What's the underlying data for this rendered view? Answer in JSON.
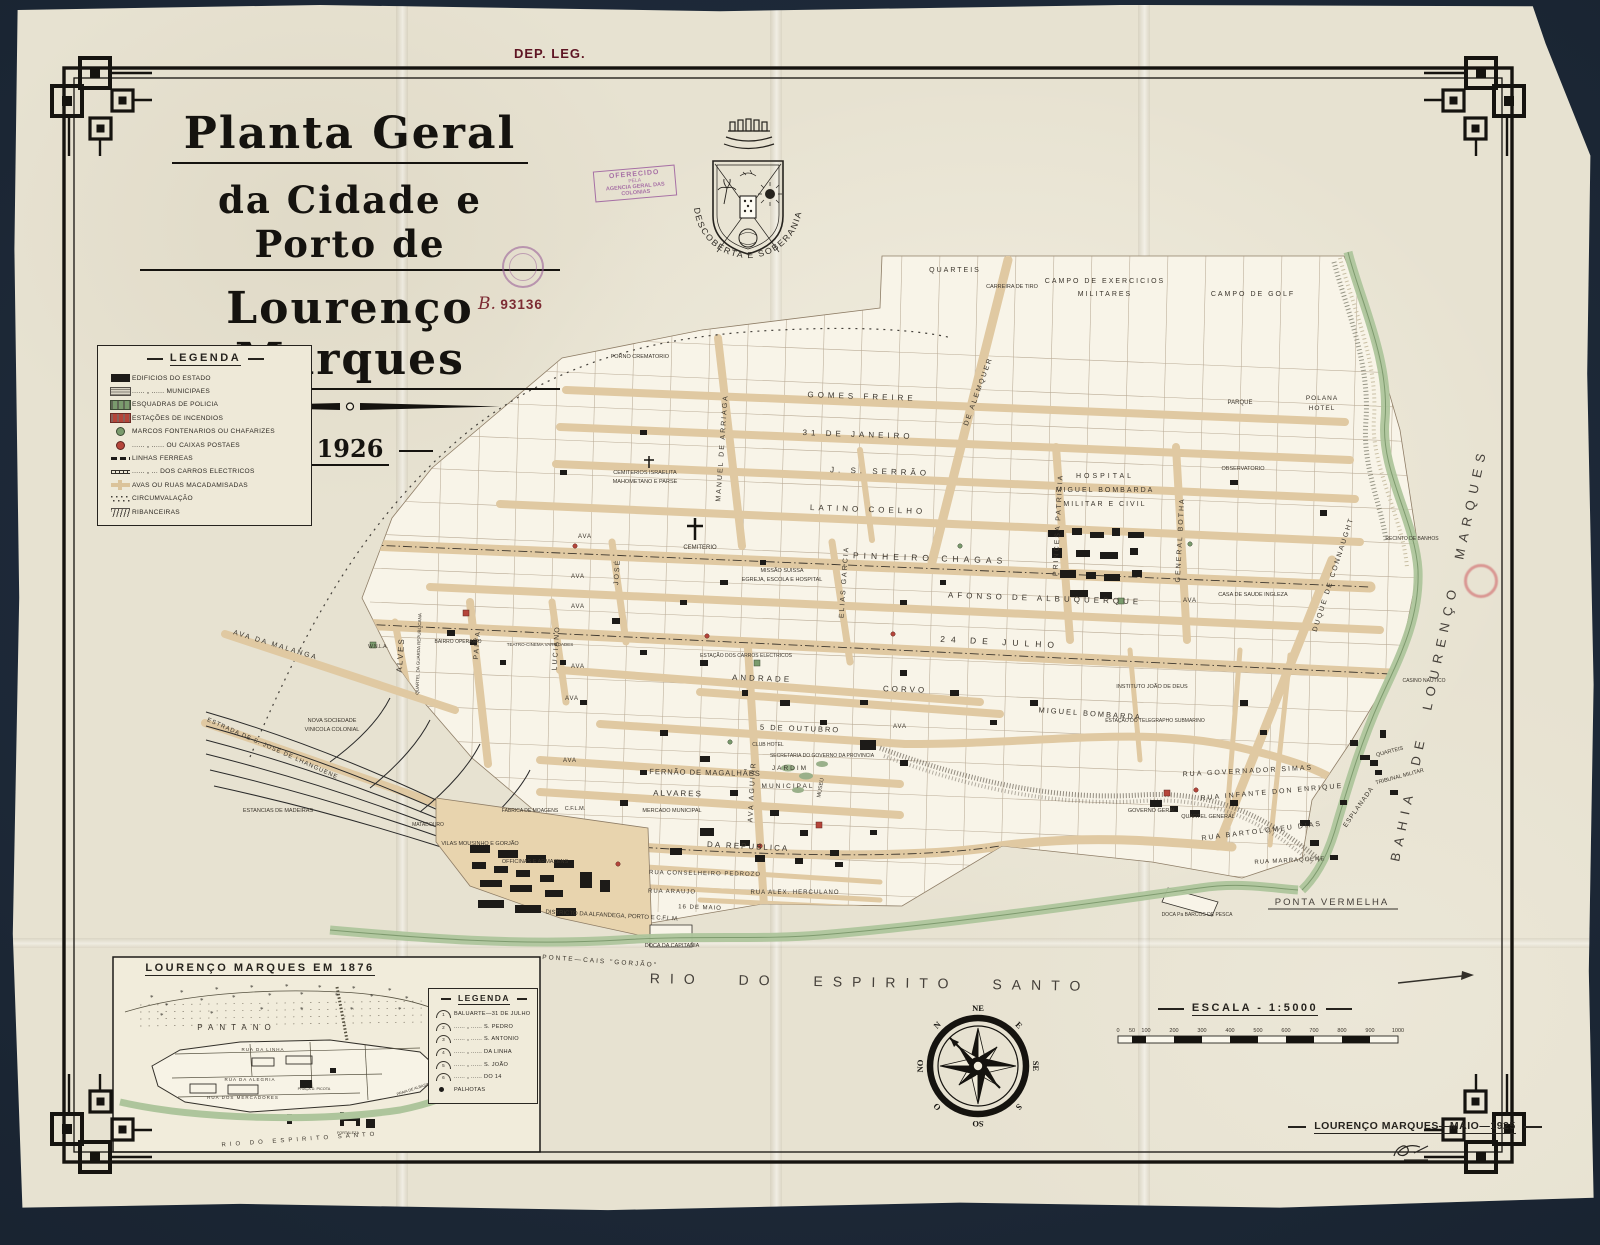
{
  "dep_leg": "DEP. LEG.",
  "title": {
    "line1": "Planta Geral",
    "line2": "da Cidade e Porto de",
    "line3": "Lourenço Marques",
    "year": "1926"
  },
  "stamps": {
    "offered": {
      "l1": "OFERECIDO",
      "l2": "PELA",
      "l3": "AGENCIA GERAL DAS COLONIAS"
    },
    "registry": {
      "prefix": "B.",
      "number": "93136"
    }
  },
  "crest": {
    "motto": "DESCOBERTA E SOBERANIA PORTUGUESA"
  },
  "legend": {
    "title": "LEGENDA",
    "items": [
      {
        "c": "sym sym-state",
        "label": "EDIFICIOS DO ESTADO"
      },
      {
        "c": "sym sym-municipal",
        "label": "...... „ ...... MUNICIPAES"
      },
      {
        "c": "sym sym-police",
        "label": "ESQUADRAS DE POLICIA"
      },
      {
        "c": "sym sym-fire",
        "label": "ESTAÇÕES DE INCENDIOS"
      },
      {
        "c": "sym sym-fountain",
        "label": "MARCOS FONTENARIOS OU CHAFARIZES"
      },
      {
        "c": "sym sym-postbox",
        "label": "...... „ ...... OU CAIXAS POSTAES"
      },
      {
        "c": "sym sym-rail",
        "label": "LINHAS FERREAS"
      },
      {
        "c": "sym sym-tram",
        "label": "...... „ ... DOS CARROS ELECTRICOS"
      },
      {
        "c": "sym sym-macadam",
        "label": "AVAS OU RUAS MACADAMISADAS"
      },
      {
        "c": "sym sym-circum",
        "label": "CIRCUMVALAÇÃO"
      },
      {
        "c": "sym sym-riban",
        "label": "RIBANCEIRAS"
      }
    ]
  },
  "map": {
    "labels": [
      {
        "t": "GOMES FREIRE",
        "x": 862,
        "y": 399,
        "r": 2,
        "s": 8,
        "ls": 4
      },
      {
        "t": "31 DE JANEIRO",
        "x": 858,
        "y": 437,
        "r": 2,
        "s": 8,
        "ls": 4
      },
      {
        "t": "J. S. SERRÃO",
        "x": 880,
        "y": 474,
        "r": 2,
        "s": 8,
        "ls": 4
      },
      {
        "t": "LATINO COELHO",
        "x": 868,
        "y": 512,
        "r": 2,
        "s": 8,
        "ls": 4
      },
      {
        "t": "PINHEIRO CHAGAS",
        "x": 930,
        "y": 561,
        "r": 2,
        "s": 8.5,
        "ls": 5
      },
      {
        "t": "AFONSO DE ALBUQUERQUE",
        "x": 1045,
        "y": 601,
        "r": 2,
        "s": 8,
        "ls": 4
      },
      {
        "t": "24 DE JULHO",
        "x": 1000,
        "y": 645,
        "r": 3,
        "s": 8.5,
        "ls": 6
      },
      {
        "t": "ANDRADE",
        "x": 762,
        "y": 681,
        "r": 2,
        "s": 8,
        "ls": 3
      },
      {
        "t": "CORVO",
        "x": 905,
        "y": 692,
        "r": 2,
        "s": 8,
        "ls": 3
      },
      {
        "t": "5 DE OUTUBRO",
        "x": 800,
        "y": 731,
        "r": 2,
        "s": 7.5,
        "ls": 2
      },
      {
        "t": "MIGUEL BOMBARDA",
        "x": 1090,
        "y": 716,
        "r": 4,
        "s": 7.5,
        "ls": 2
      },
      {
        "t": "FERNÃO DE MAGALHÃES",
        "x": 705,
        "y": 775,
        "r": 1,
        "s": 7.5,
        "ls": 1
      },
      {
        "t": "ALVARES",
        "x": 678,
        "y": 796,
        "r": 1,
        "s": 8,
        "ls": 2
      },
      {
        "t": "DA REPUBLICA",
        "x": 748,
        "y": 849,
        "r": 3,
        "s": 8,
        "ls": 2
      },
      {
        "t": "RUA CONSELHEIRO PEDROZO",
        "x": 705,
        "y": 875,
        "r": 1,
        "s": 6,
        "ls": 1
      },
      {
        "t": "RUA ARAUJO",
        "x": 672,
        "y": 893,
        "r": 1,
        "s": 6,
        "ls": 1
      },
      {
        "t": "RUA ALEX. HERCULANO",
        "x": 795,
        "y": 894,
        "r": 0,
        "s": 6,
        "ls": 1
      },
      {
        "t": "16 DE MAIO",
        "x": 700,
        "y": 909,
        "r": 2,
        "s": 6,
        "ls": 1
      },
      {
        "t": "RUA GOVERNADOR SIMAS",
        "x": 1248,
        "y": 773,
        "r": -3,
        "s": 7,
        "ls": 2
      },
      {
        "t": "RUA INFANTE DON ENRIQUE",
        "x": 1272,
        "y": 794,
        "r": -5,
        "s": 7,
        "ls": 2
      },
      {
        "t": "RUA BARTOLOMEU DIAS",
        "x": 1262,
        "y": 833,
        "r": -7,
        "s": 7,
        "ls": 2
      },
      {
        "t": "RUA MARRAQUENE",
        "x": 1290,
        "y": 862,
        "r": -3,
        "s": 6,
        "ls": 1
      },
      {
        "t": "MANUEL DE ARRIAGA",
        "x": 724,
        "y": 448,
        "r": -86,
        "s": 7,
        "ls": 2
      },
      {
        "t": "DE ALEMQUER",
        "x": 980,
        "y": 392,
        "r": -70,
        "s": 7,
        "ls": 2
      },
      {
        "t": "ELIAS GARCIA",
        "x": 846,
        "y": 582,
        "r": -86,
        "s": 7,
        "ls": 2
      },
      {
        "t": "PRINCESA PATRICIA",
        "x": 1060,
        "y": 525,
        "r": -87,
        "s": 7,
        "ls": 2
      },
      {
        "t": "GENERAL BOTHA",
        "x": 1182,
        "y": 540,
        "r": -87,
        "s": 7,
        "ls": 2
      },
      {
        "t": "DUQUE DE CONNAUGHT",
        "x": 1335,
        "y": 575,
        "r": -72,
        "s": 7,
        "ls": 2
      },
      {
        "t": "ESPLANADA",
        "x": 1360,
        "y": 808,
        "r": -55,
        "s": 6.5,
        "ls": 1
      },
      {
        "t": "AVA AGUIAR",
        "x": 754,
        "y": 792,
        "r": -87,
        "s": 7,
        "ls": 2
      },
      {
        "t": "PAIVA",
        "x": 479,
        "y": 645,
        "r": -86,
        "s": 7,
        "ls": 2
      },
      {
        "t": "LUCIANO",
        "x": 558,
        "y": 648,
        "r": -86,
        "s": 7,
        "ls": 2
      },
      {
        "t": "JOSÉ",
        "x": 619,
        "y": 572,
        "r": -86,
        "s": 7,
        "ls": 2
      },
      {
        "t": "ALVES",
        "x": 403,
        "y": 655,
        "r": -86,
        "s": 8,
        "ls": 2
      },
      {
        "t": "AVA DA MALANGA",
        "x": 275,
        "y": 647,
        "r": 17,
        "s": 7,
        "ls": 2
      },
      {
        "t": "ESTRADA DE S. JOSÉ DE LHANGUENE",
        "x": 272,
        "y": 750,
        "r": 24,
        "s": 6,
        "ls": 1
      },
      {
        "t": "QUARTEIS",
        "x": 955,
        "y": 272,
        "s": 7,
        "ls": 2
      },
      {
        "t": "CARREIRA DE TIRO",
        "x": 1012,
        "y": 288,
        "s": 5.5
      },
      {
        "t": "CAMPO DE EXERCICIOS",
        "x": 1105,
        "y": 283,
        "s": 7,
        "ls": 2
      },
      {
        "t": "MILITARES",
        "x": 1105,
        "y": 296,
        "s": 7,
        "ls": 2
      },
      {
        "t": "CAMPO DE GOLF",
        "x": 1253,
        "y": 296,
        "s": 7,
        "ls": 2
      },
      {
        "t": "PARQUE",
        "x": 1240,
        "y": 404,
        "s": 6
      },
      {
        "t": "POLANA",
        "x": 1322,
        "y": 400,
        "s": 6.5,
        "ls": 1
      },
      {
        "t": "HOTEL",
        "x": 1322,
        "y": 410,
        "s": 6.5,
        "ls": 1
      },
      {
        "t": "OBSERVATORIO",
        "x": 1243,
        "y": 470,
        "s": 5.5
      },
      {
        "t": "HOSPITAL",
        "x": 1105,
        "y": 478,
        "s": 7,
        "ls": 3
      },
      {
        "t": "MIGUEL BOMBARDA",
        "x": 1105,
        "y": 492,
        "s": 7,
        "ls": 2
      },
      {
        "t": "MILITAR E CIVIL",
        "x": 1105,
        "y": 506,
        "s": 7,
        "ls": 2
      },
      {
        "t": "CASA DE SAUDE INGLEZA",
        "x": 1253,
        "y": 596,
        "s": 5.5
      },
      {
        "t": "FORNO CREMATORIO",
        "x": 640,
        "y": 358,
        "s": 5.5
      },
      {
        "t": "CEMITERIO",
        "x": 700,
        "y": 549,
        "s": 6
      },
      {
        "t": "CEMITERIOS ISRAELITA",
        "x": 645,
        "y": 474,
        "s": 5.5
      },
      {
        "t": "MAHOMETANO E PARSE",
        "x": 645,
        "y": 483,
        "s": 5.5
      },
      {
        "t": "MISSÃO SUISSA",
        "x": 782,
        "y": 572,
        "s": 5.5
      },
      {
        "t": "EGREJA, ESCOLA E HOSPITAL",
        "x": 782,
        "y": 581,
        "s": 5.5
      },
      {
        "t": "ESTAÇÃO DOS CARROS ELECTRICOS",
        "x": 746,
        "y": 657,
        "s": 5
      },
      {
        "t": "JARDIM",
        "x": 790,
        "y": 770,
        "s": 6.5,
        "ls": 2
      },
      {
        "t": "MUNICIPAL",
        "x": 788,
        "y": 788,
        "s": 6.5,
        "ls": 2
      },
      {
        "t": "MUSEU",
        "x": 822,
        "y": 788,
        "r": -80,
        "s": 5.5
      },
      {
        "t": "MERCADO MUNICIPAL",
        "x": 672,
        "y": 812,
        "s": 5.5
      },
      {
        "t": "SECRETARIA DO GOVERNO DA PROVINCIA",
        "x": 822,
        "y": 757,
        "s": 5
      },
      {
        "t": "CLUB HOTEL",
        "x": 768,
        "y": 746,
        "s": 5
      },
      {
        "t": "GOVERNO GERAL",
        "x": 1152,
        "y": 812,
        "s": 5.5
      },
      {
        "t": "QUARTEL GENERAL",
        "x": 1208,
        "y": 818,
        "s": 5.5
      },
      {
        "t": "INSTITUTO JOÃO DE DEUS",
        "x": 1152,
        "y": 688,
        "s": 5.5
      },
      {
        "t": "ESTAÇÃO DO TELEGRAPHO SUBMARINO",
        "x": 1155,
        "y": 722,
        "s": 5
      },
      {
        "t": "RECINTO DE BANHOS",
        "x": 1412,
        "y": 540,
        "s": 5
      },
      {
        "t": "CASINO NAUTICO",
        "x": 1424,
        "y": 682,
        "s": 5
      },
      {
        "t": "QUARTEIS",
        "x": 1390,
        "y": 753,
        "r": -15,
        "s": 5.5
      },
      {
        "t": "TRIBUNAL MILITAR",
        "x": 1400,
        "y": 778,
        "r": -15,
        "s": 5.5
      },
      {
        "t": "NOVA SOCIEDADE",
        "x": 332,
        "y": 722,
        "s": 5.5
      },
      {
        "t": "VINICOLA COLONIAL",
        "x": 332,
        "y": 731,
        "s": 5.5
      },
      {
        "t": "ESTANCIAS DE MADEIRAS",
        "x": 278,
        "y": 812,
        "s": 5.5
      },
      {
        "t": "MATADOURO",
        "x": 428,
        "y": 826,
        "s": 5
      },
      {
        "t": "VILAS MOUSINHO E GORJÃO",
        "x": 480,
        "y": 845,
        "s": 5.5
      },
      {
        "t": "OFFICINAS E ARMAZENS",
        "x": 535,
        "y": 863,
        "s": 5.5
      },
      {
        "t": "FABRICA DE MOAGENS",
        "x": 530,
        "y": 812,
        "s": 5
      },
      {
        "t": "C.F.L.M.",
        "x": 575,
        "y": 810,
        "s": 5.5
      },
      {
        "t": "BAIRRO OPERARIO",
        "x": 458,
        "y": 643,
        "s": 5
      },
      {
        "t": "TEATRO-CINEMA VARIEDADES",
        "x": 540,
        "y": 646,
        "s": 4.5
      },
      {
        "t": "QUARTEL DA GUARDA REPUBLICANA",
        "x": 420,
        "y": 654,
        "r": -88,
        "s": 4.5
      },
      {
        "t": "W.N.L.A.",
        "x": 378,
        "y": 648,
        "s": 5
      },
      {
        "t": "DISTRICTO DA ALFANDEGA, PORTO E C.F.L.M.",
        "x": 612,
        "y": 917,
        "r": 3,
        "s": 6
      },
      {
        "t": "PONTE—CAIS \"GORJÃO\"",
        "x": 600,
        "y": 963,
        "r": 4,
        "s": 6.5,
        "ls": 2
      },
      {
        "t": "DOCA DA CAPITANIA",
        "x": 672,
        "y": 947,
        "s": 5.5
      },
      {
        "t": "DOCA Pa BARCOS DE PESCA",
        "x": 1197,
        "y": 916,
        "s": 5
      },
      {
        "t": "PONTA VERMELHA",
        "x": 1332,
        "y": 905,
        "s": 9.5,
        "ls": 2,
        "big": 1
      },
      {
        "t": "RIO DO ESPIRITO SANTO",
        "x": 870,
        "y": 987,
        "r": 1,
        "s": 14,
        "ls": 10,
        "ws": 20,
        "big": 1
      },
      {
        "t": "BAHIA DE LOURENÇO MARQUES",
        "x": 1443,
        "y": 655,
        "r": -78,
        "s": 13,
        "ls": 7,
        "ws": 14,
        "big": 1
      },
      {
        "t": "AVA",
        "x": 585,
        "y": 538,
        "s": 6,
        "ls": 1
      },
      {
        "t": "AVA",
        "x": 578,
        "y": 578,
        "s": 6,
        "ls": 1
      },
      {
        "t": "AVA",
        "x": 578,
        "y": 608,
        "s": 6,
        "ls": 1
      },
      {
        "t": "AVA",
        "x": 578,
        "y": 668,
        "s": 6,
        "ls": 1
      },
      {
        "t": "AVA",
        "x": 572,
        "y": 700,
        "s": 6,
        "ls": 1
      },
      {
        "t": "AVA",
        "x": 570,
        "y": 762,
        "s": 6,
        "ls": 1
      },
      {
        "t": "AVA",
        "x": 1190,
        "y": 602,
        "s": 6,
        "ls": 1
      },
      {
        "t": "AVA",
        "x": 900,
        "y": 728,
        "s": 6,
        "ls": 1
      }
    ]
  },
  "inset": {
    "title": "LOURENÇO MARQUES EM 1876",
    "labels": [
      {
        "t": "PANTANO",
        "x": 237,
        "y": 1030,
        "s": 8,
        "ls": 6
      },
      {
        "t": "RUA DA LINHA",
        "x": 263,
        "y": 1051,
        "s": 4.5,
        "ls": 1
      },
      {
        "t": "RUA DA ALEGRIA",
        "x": 250,
        "y": 1081,
        "s": 4.5,
        "ls": 1
      },
      {
        "t": "RUA DOS MERCADORES",
        "x": 243,
        "y": 1099,
        "s": 4.5,
        "ls": 1
      },
      {
        "t": "PRAÇA D. PICOTA",
        "x": 314,
        "y": 1090,
        "s": 3.8
      },
      {
        "t": "PRAIA DE ALBASINI",
        "x": 414,
        "y": 1090,
        "r": -18,
        "s": 3.8
      },
      {
        "t": "FORTALEZA",
        "x": 348,
        "y": 1134,
        "s": 3.8
      },
      {
        "t": "RIO DO ESPIRITO SANTO",
        "x": 300,
        "y": 1141,
        "r": -4,
        "s": 6,
        "ls": 4
      }
    ],
    "legend": {
      "title": "LEGENDA",
      "items": [
        {
          "ic": "ic mound",
          "n": "1",
          "label": "BALUARTE—31 DE JULHO"
        },
        {
          "ic": "ic mound",
          "n": "2",
          "label": "...... „ ...... S. PEDRO"
        },
        {
          "ic": "ic mound",
          "n": "3",
          "label": "...... „ ...... S. ANTONIO"
        },
        {
          "ic": "ic mound",
          "n": "4",
          "label": "...... „ ...... DA LINHA"
        },
        {
          "ic": "ic mound",
          "n": "5",
          "label": "...... „ ...... S. JOÃO"
        },
        {
          "ic": "ic mound",
          "n": "6",
          "label": "...... „ ...... DO 14"
        },
        {
          "ic": "ic dot",
          "n": "",
          "label": "PALHOTAS"
        }
      ]
    }
  },
  "compass": {
    "directions": [
      "NE",
      "E",
      "SE",
      "S",
      "SO",
      "O",
      "NO",
      "N"
    ]
  },
  "scale": {
    "title": "ESCALA - 1:5000",
    "ticks": [
      {
        "m": 0,
        "label": "0"
      },
      {
        "m": 50,
        "label": "50"
      },
      {
        "m": 100,
        "label": "100"
      },
      {
        "m": 200,
        "label": "200"
      },
      {
        "m": 300,
        "label": "300"
      },
      {
        "m": 400,
        "label": "400"
      },
      {
        "m": 500,
        "label": "500"
      },
      {
        "m": 600,
        "label": "600"
      },
      {
        "m": 700,
        "label": "700"
      },
      {
        "m": 800,
        "label": "800"
      },
      {
        "m": 900,
        "label": "900"
      },
      {
        "m": 1000,
        "label": "1000"
      }
    ]
  },
  "credit": {
    "text": "LOURENÇO MARQUES—MAIO—1925"
  }
}
